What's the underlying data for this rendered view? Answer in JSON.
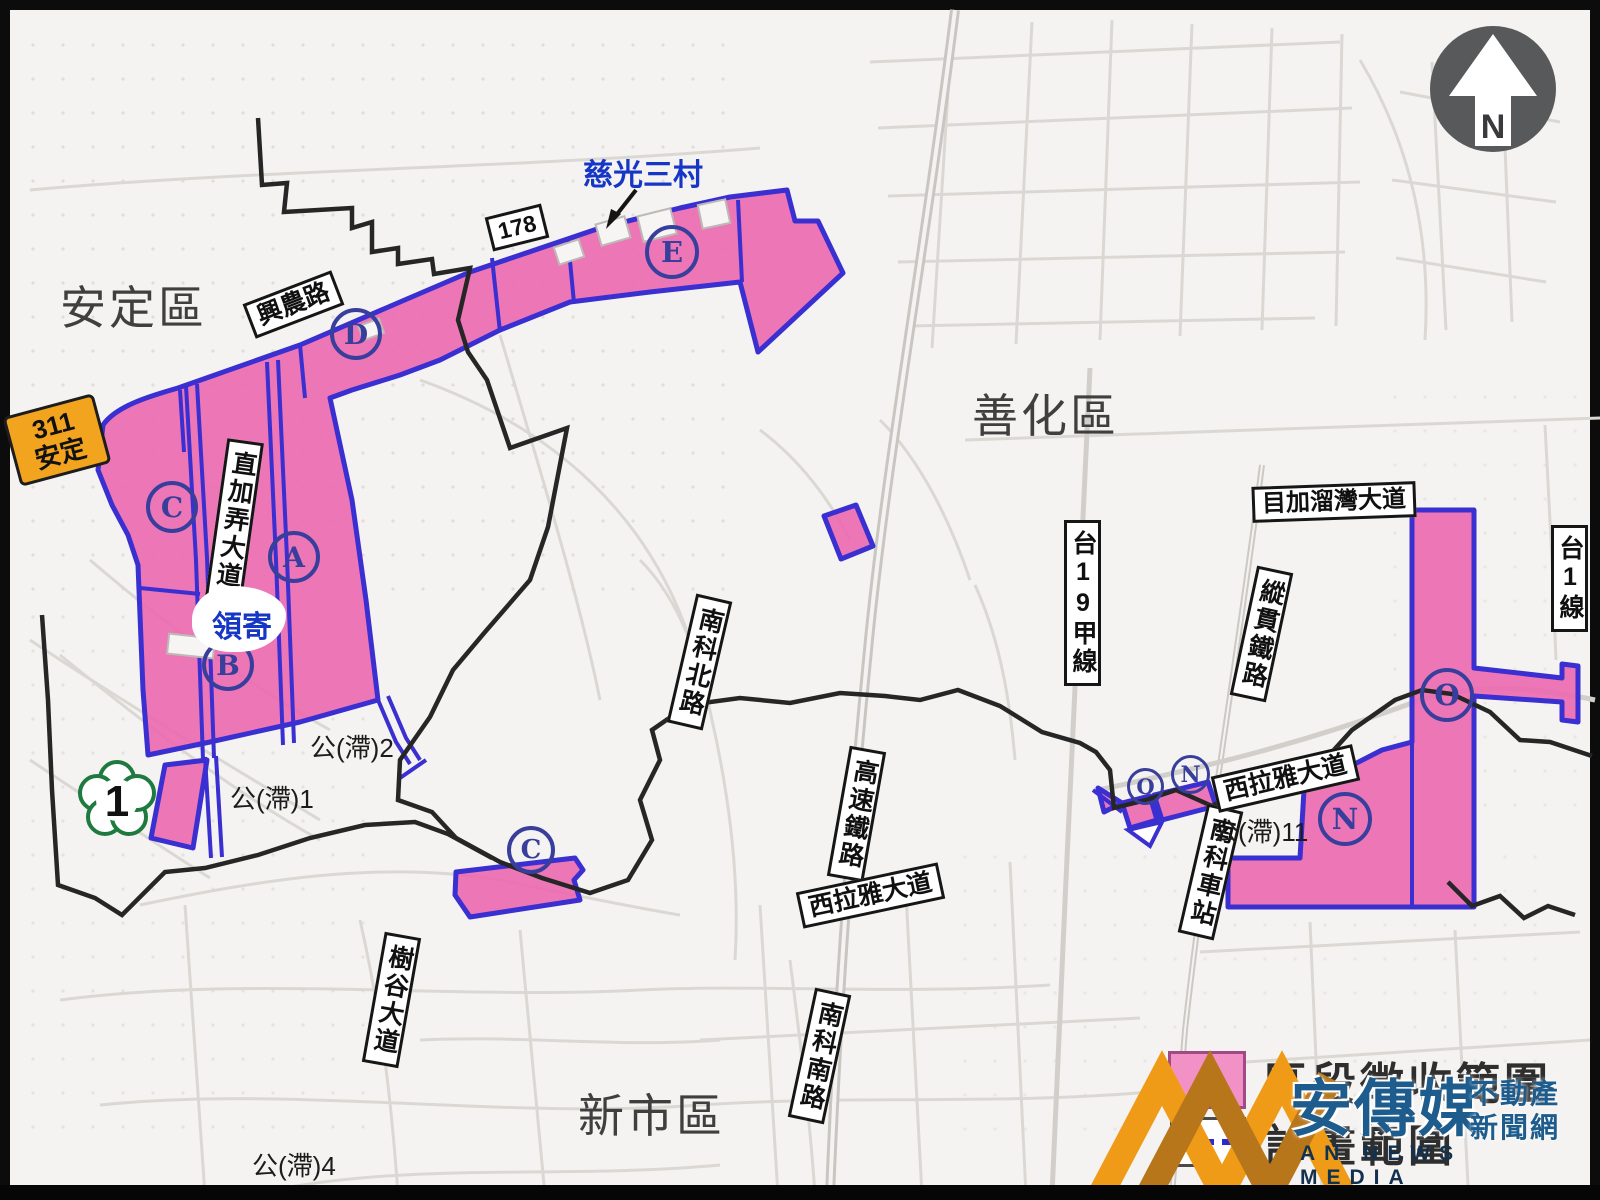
{
  "districts": [
    {
      "label": "安定區"
    },
    {
      "label": "善化區"
    },
    {
      "label": "新市區"
    }
  ],
  "road_signs": [
    {
      "label": "興農路"
    },
    {
      "label": "178"
    },
    {
      "label": "直加弄大道"
    },
    {
      "label": "南科北路"
    },
    {
      "label": "高速鐵路"
    },
    {
      "label": "西拉雅大道"
    },
    {
      "label": "南科南路"
    },
    {
      "label": "樹谷大道"
    },
    {
      "label": "台19甲線"
    },
    {
      "label": "縱貫鐵路"
    },
    {
      "label": "目加溜灣大道"
    },
    {
      "label": "台1線"
    },
    {
      "label": "南科車站"
    },
    {
      "label": "西拉雅大道"
    }
  ],
  "detention_labels": [
    {
      "label": "公(滯)2"
    },
    {
      "label": "公(滯)1"
    },
    {
      "label": "公(滯)4"
    },
    {
      "label": "公(滯)11"
    }
  ],
  "zone_badges": [
    {
      "letter": "D"
    },
    {
      "letter": "E"
    },
    {
      "letter": "C"
    },
    {
      "letter": "A"
    },
    {
      "letter": "B"
    },
    {
      "letter": "C"
    },
    {
      "letter": "O"
    },
    {
      "letter": "N"
    },
    {
      "letter": "O"
    },
    {
      "letter": "N"
    }
  ],
  "poi": {
    "village": "慈光三村",
    "lingji": "領寄"
  },
  "shields": {
    "county_route": {
      "number": "311",
      "name": "安定"
    },
    "freeway": {
      "number": "1"
    }
  },
  "north_arrow": {
    "label": "N"
  },
  "legend": {
    "items": [
      {
        "label": "區段徵收範圍"
      },
      {
        "label": "計畫範圍"
      }
    ]
  },
  "watermark": {
    "brand": "安傳媒",
    "tag1": "不動產",
    "tag2": "新聞網",
    "brand_en": "AN NEWS MEDIA"
  },
  "colors": {
    "zone_fill": "#ec68b0",
    "zone_border": "#3a2fd0",
    "badge": "#383e9c",
    "poi_text": "#1636c6",
    "county_sign_bg": "#f2a41f",
    "freeway_green": "#1e7a3e",
    "legend_pink": "#f291c5"
  }
}
